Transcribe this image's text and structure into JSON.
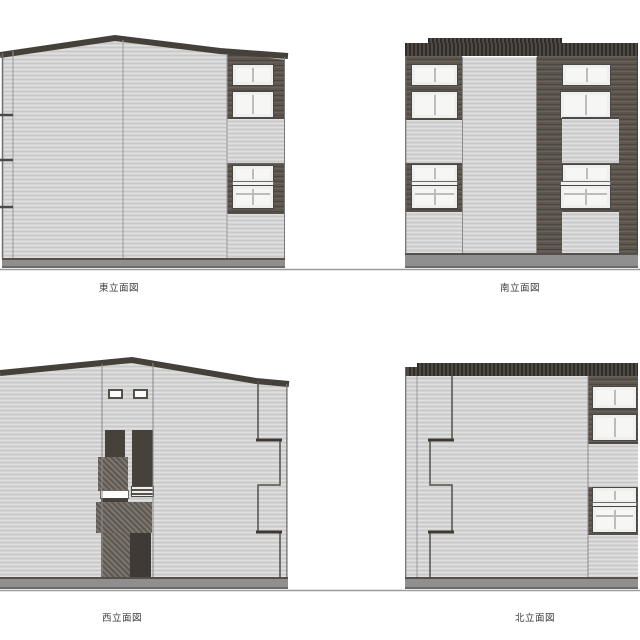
{
  "sheet": {
    "background": "#ffffff"
  },
  "colors": {
    "siding_light": "#d3d4d3",
    "brick_dark": "#5d564e",
    "parapet_roof_dark": "#433d36",
    "accent_panel_dark": "#47413b",
    "speckle_block": "#6e6760",
    "base_band": "#8f8f8f",
    "window_frame": "#efefed",
    "window_pane": "#f6f6f4",
    "ground_line": "#9b9b9b",
    "label_text": "#3d3d3d"
  },
  "elevations": [
    {
      "id": "east",
      "label": "東立面図",
      "position": "top-left",
      "roof": "gabled"
    },
    {
      "id": "south",
      "label": "南立面図",
      "position": "top-right",
      "roof": "flat-parapet"
    },
    {
      "id": "west",
      "label": "西立面図",
      "position": "bottom-left",
      "roof": "gabled"
    },
    {
      "id": "north",
      "label": "北立面図",
      "position": "bottom-right",
      "roof": "flat-parapet"
    }
  ]
}
